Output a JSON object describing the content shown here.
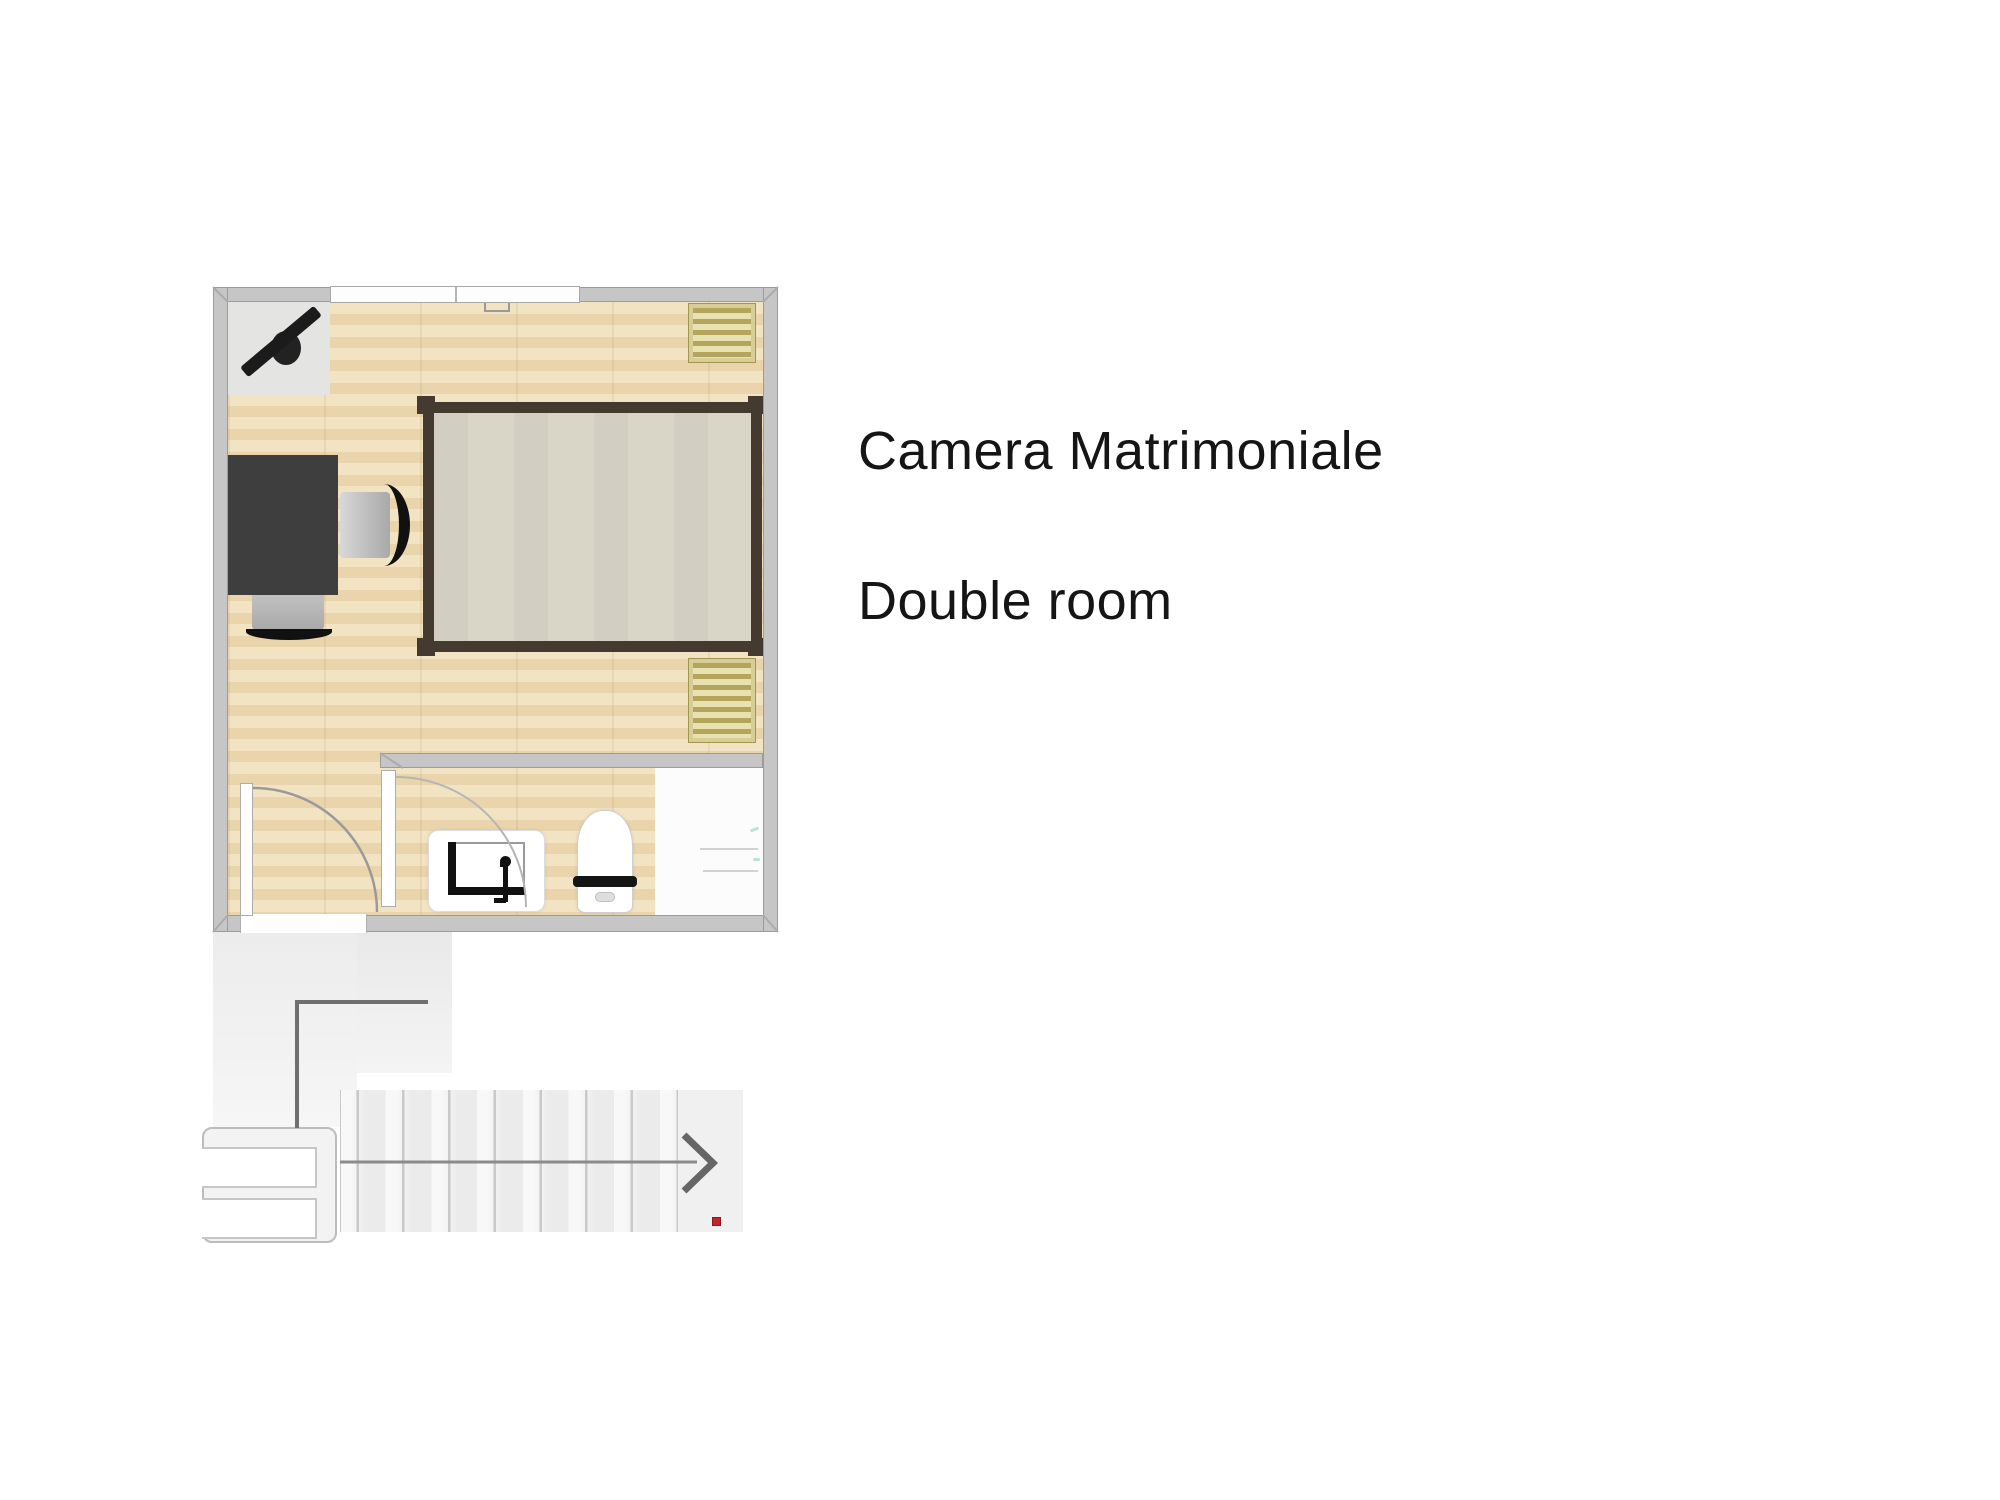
{
  "page": {
    "background_color": "#ffffff"
  },
  "annotation": {
    "room_label_italian": "Camera Matrimoniale",
    "room_label_english": "Double room",
    "text_color": "#151515"
  },
  "floorplan": {
    "type": "top-down residential floor plan",
    "description": "double bedroom with en-suite bathroom, entry hallway and staircase leading down-right",
    "palette": {
      "page_bg": "#ffffff",
      "wall_fill": "#c6c6c6",
      "wall_edge": "#9b9b9b",
      "wood_floor_light": "#f2e3c2",
      "wood_floor_dark": "#ead4ab",
      "mat": "#e4e4e2",
      "tv": "#1b1b1b",
      "desk": "#3e3e3e",
      "chair_back": "#111111",
      "bed_frame": "#453a2f",
      "mattress": "#d9d5c7",
      "radiator_frame": "#d7cd97",
      "radiator_dark": "#b3a55c",
      "radiator_light": "#e9e1af",
      "shower_floor": "#fcfcfc",
      "stairs_fill": "#f0f0f0",
      "stair_line": "#c9c9c9",
      "red_marker": "#c3232b",
      "text_color": "#151515"
    },
    "elements": [
      "exterior walls",
      "window in top wall",
      "wall-mounted tv on corner mat",
      "desk",
      "desk chair (right)",
      "desk chair (below)",
      "double bed with mattress",
      "radiator upper right",
      "radiator lower right",
      "en-suite bathroom",
      "sink vanity with faucet",
      "toilet",
      "shower area",
      "entry door with swing arc",
      "bathroom door with swing arc",
      "hallway",
      "stair landing with two steps",
      "staircase with nine treads",
      "direction arrow pointing right",
      "red position marker"
    ]
  }
}
